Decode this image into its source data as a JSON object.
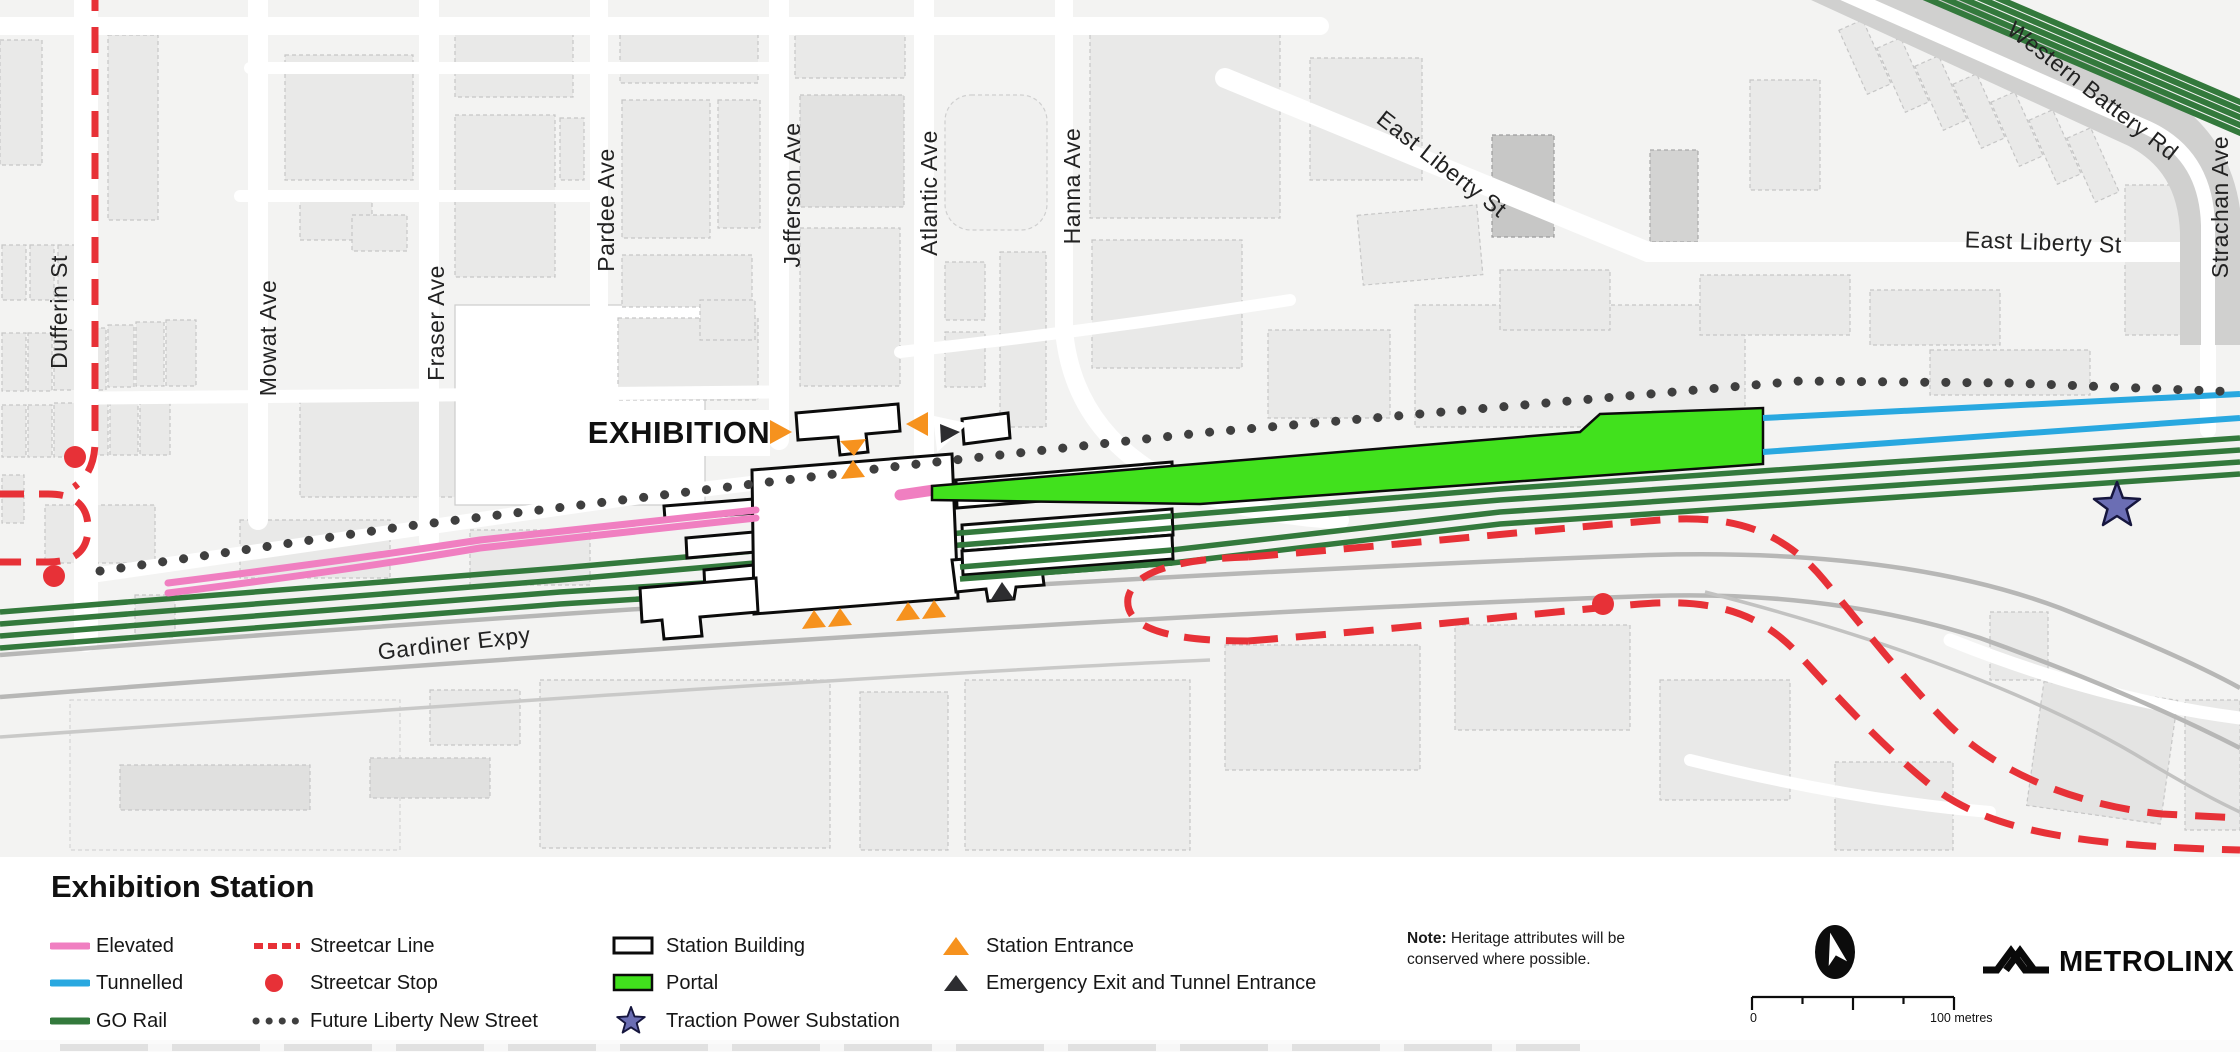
{
  "map": {
    "station_label": "EXHIBITION",
    "streets": {
      "dufferin": "Dufferin St",
      "mowat": "Mowat Ave",
      "fraser": "Fraser Ave",
      "pardee": "Pardee Ave",
      "jefferson": "Jefferson Ave",
      "atlantic": "Atlantic Ave",
      "hanna": "Hanna Ave",
      "east_liberty_west": "East Liberty St",
      "east_liberty_east": "East Liberty St",
      "western_battery": "Western Battery Rd",
      "strachan": "Strachan Ave",
      "gardiner": "Gardiner Expy"
    }
  },
  "legend": {
    "title": "Exhibition Station",
    "items": {
      "elevated": "Elevated",
      "tunnelled": "Tunnelled",
      "go_rail": "GO Rail",
      "streetcar_line": "Streetcar Line",
      "streetcar_stop": "Streetcar Stop",
      "future_liberty": "Future Liberty New Street",
      "station_building": "Station Building",
      "portal": "Portal",
      "traction": "Traction Power Substation",
      "station_entrance": "Station Entrance",
      "emergency": "Emergency Exit and Tunnel Entrance"
    }
  },
  "note": {
    "label": "Note:",
    "text": " Heritage attributes will be conserved where possible."
  },
  "scale_bar": {
    "start": "0",
    "end": "100 metres"
  },
  "brand": {
    "name": "METROLINX"
  },
  "colors": {
    "elevated_pink": "#f07fc1",
    "tunnelled_blue": "#29a8e0",
    "go_green": "#33793c",
    "portal_green": "#41e11d",
    "streetcar_red": "#e73137",
    "entrance_orange": "#f6921e",
    "substation_purple": "#6b6eb4",
    "future_street_dot": "#3f3f3f",
    "map_background": "#f3f3f2"
  }
}
